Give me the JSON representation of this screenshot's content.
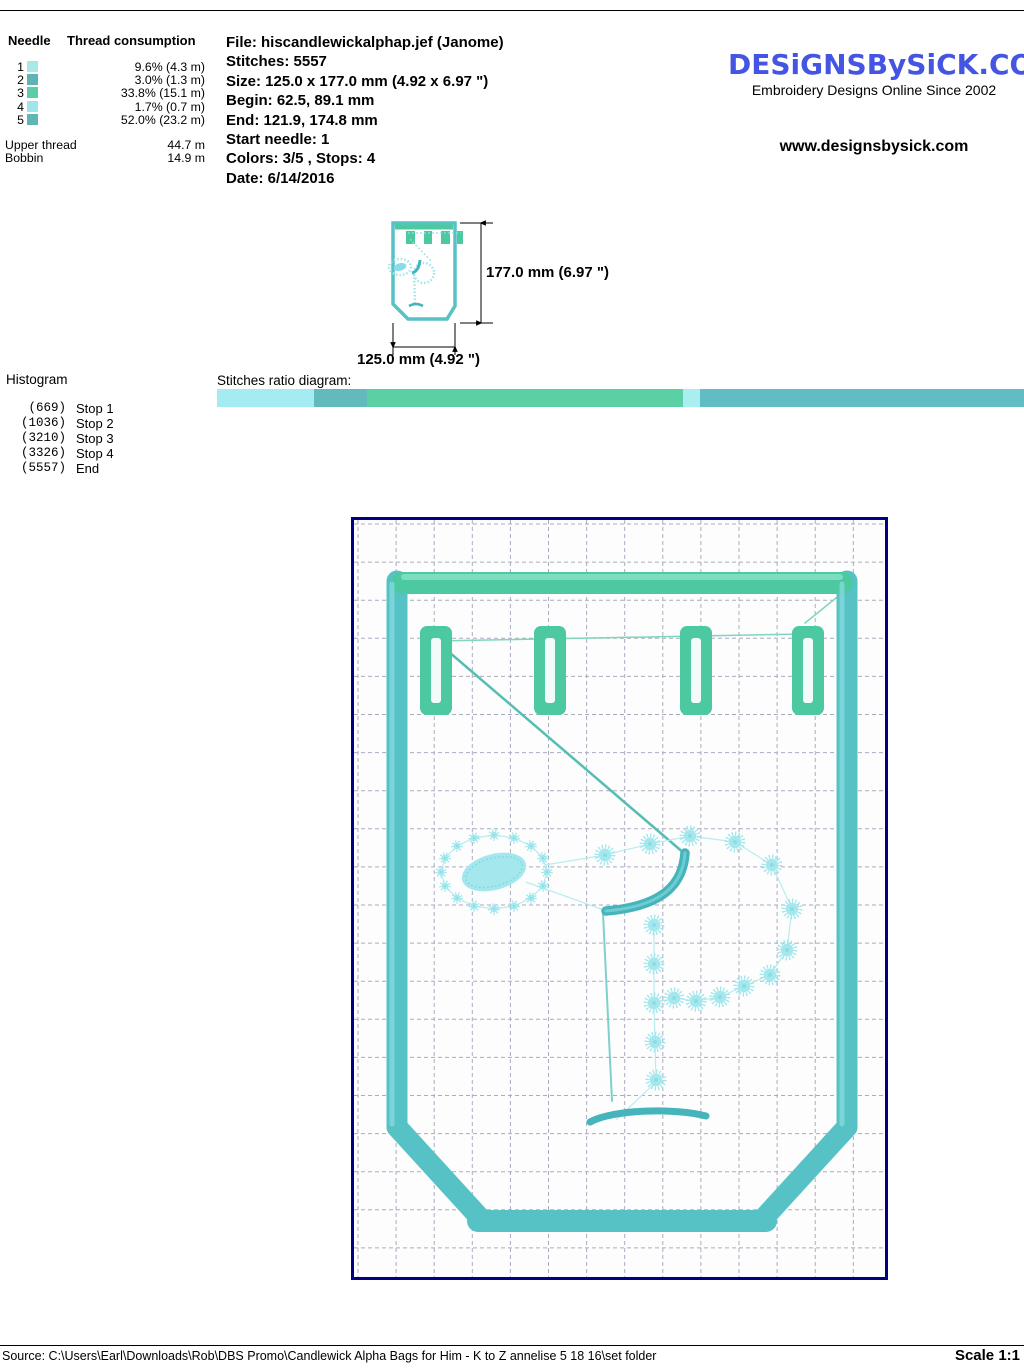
{
  "needle_table": {
    "col_needle": "Needle",
    "col_thread": "Thread consumption",
    "rows": [
      {
        "needle": "1",
        "color": "#a7e9e6",
        "value": "9.6% (4.3 m)"
      },
      {
        "needle": "2",
        "color": "#5fb3b5",
        "value": "3.0% (1.3 m)"
      },
      {
        "needle": "3",
        "color": "#5ccda6",
        "value": "33.8% (15.1 m)"
      },
      {
        "needle": "4",
        "color": "#a0e5eb",
        "value": "1.7% (0.7 m)"
      },
      {
        "needle": "5",
        "color": "#60b6b3",
        "value": "52.0% (23.2 m)"
      }
    ],
    "upper_thread_label": "Upper thread",
    "upper_thread_value": "44.7 m",
    "bobbin_label": "Bobbin",
    "bobbin_value": "14.9 m"
  },
  "file_info": {
    "lines": [
      "File: hiscandlewickalphap.jef  (Janome)",
      "Stitches: 5557",
      "Size: 125.0 x 177.0 mm (4.92 x 6.97 \")",
      "Begin: 62.5, 89.1 mm",
      "End: 121.9, 174.8 mm",
      "Start needle: 1",
      "Colors: 3/5 , Stops: 4",
      "Date: 6/14/2016"
    ]
  },
  "brand": {
    "logo": "DESiGNSBySiCK.COM",
    "logo_color": "#4355e2",
    "tagline": "Embroidery Designs Online Since 2002",
    "website": "www.designsbysick.com"
  },
  "thumbnail": {
    "height_label": "177.0 mm (6.97 \")",
    "width_label": "125.0 mm (4.92 \")"
  },
  "histogram": {
    "title": "Histogram",
    "rows": [
      {
        "count": "(669)",
        "label": "Stop 1"
      },
      {
        "count": "(1036)",
        "label": "Stop 2"
      },
      {
        "count": "(3210)",
        "label": "Stop 3"
      },
      {
        "count": "(3326)",
        "label": "Stop 4"
      },
      {
        "count": "(5557)",
        "label": "End"
      }
    ]
  },
  "ratio": {
    "label": "Stitches ratio diagram:",
    "segments": [
      {
        "pct": 12.04,
        "color": "#a5ecf2"
      },
      {
        "pct": 6.6,
        "color": "#63babd"
      },
      {
        "pct": 39.12,
        "color": "#5bd0a5"
      },
      {
        "pct": 2.09,
        "color": "#abeef2"
      },
      {
        "pct": 40.15,
        "color": "#60bdc4"
      }
    ]
  },
  "design": {
    "colors": {
      "applique_green": "#4cc9a0",
      "green_hi": "#8ae2c6",
      "border_teal": "#56c2c6",
      "teal_hi": "#8adde0",
      "crook_teal": "#45b4bb",
      "star_cyan": "#a4e8ee",
      "star_core": "#7ed4de",
      "thread_light": "#b9ecee",
      "grid": "#a9abc0",
      "slot_fill": "#f2fbfa"
    },
    "grid": {
      "step": 38.1,
      "offset": 4
    },
    "bars": {
      "top": [
        [
          48,
          63
        ],
        [
          488,
          63
        ]
      ],
      "left": [
        [
          43,
          61
        ],
        [
          43,
          607
        ]
      ],
      "right": [
        [
          493,
          61
        ],
        [
          493,
          607
        ]
      ],
      "chamfer_left": [
        [
          43,
          607
        ],
        [
          127,
          699
        ]
      ],
      "chamfer_right": [
        [
          493,
          607
        ],
        [
          409,
          699
        ]
      ],
      "bottom": [
        [
          124,
          701
        ],
        [
          412,
          701
        ]
      ]
    },
    "tabs": {
      "xs": [
        66,
        180,
        326,
        438
      ],
      "y": 106,
      "w": 32,
      "h": 89
    },
    "jump_lines": [
      {
        "pts": [
          [
            80,
            121
          ],
          [
            450,
            114
          ]
        ],
        "w": 1.5,
        "color": "#7dd7b8"
      },
      {
        "pts": [
          [
            451,
            103
          ],
          [
            492,
            70
          ]
        ],
        "w": 1.5,
        "color": "#7dd7b8"
      },
      {
        "pts": [
          [
            95,
            132
          ],
          [
            331,
            334
          ]
        ],
        "w": 2.5,
        "color": "#56bdb2"
      }
    ],
    "stars": {
      "ring_r": 5.5,
      "ring": [
        [
          193,
          352
        ],
        [
          189,
          338
        ],
        [
          177,
          326
        ],
        [
          160,
          318
        ],
        [
          140,
          315
        ],
        [
          120,
          318
        ],
        [
          103,
          326
        ],
        [
          91,
          338
        ],
        [
          87,
          352
        ],
        [
          91,
          366
        ],
        [
          103,
          378
        ],
        [
          120,
          386
        ],
        [
          140,
          389
        ],
        [
          160,
          386
        ],
        [
          177,
          378
        ],
        [
          189,
          366
        ]
      ],
      "bowl_r": 10,
      "bowl": [
        [
          251,
          335
        ],
        [
          296,
          324
        ],
        [
          336,
          316
        ],
        [
          381,
          322
        ],
        [
          418,
          345
        ],
        [
          438,
          389
        ],
        [
          433,
          430
        ],
        [
          416,
          455
        ],
        [
          390,
          466
        ],
        [
          366,
          477
        ],
        [
          342,
          481
        ],
        [
          320,
          478
        ]
      ],
      "stem_r": 10,
      "stem": [
        [
          300,
          405
        ],
        [
          300,
          444
        ],
        [
          300,
          483
        ],
        [
          301,
          522
        ],
        [
          302,
          560
        ]
      ]
    },
    "thin_links": [
      [
        [
          191,
          345
        ],
        [
          251,
          335
        ]
      ],
      [
        [
          172,
          362
        ],
        [
          250,
          390
        ]
      ],
      [
        [
          320,
          478
        ],
        [
          300,
          483
        ]
      ],
      [
        [
          302,
          562
        ],
        [
          262,
          600
        ]
      ]
    ],
    "leaf": {
      "cx": 140,
      "cy": 352,
      "rx": 33,
      "ry": 18,
      "rot": -15
    },
    "crook_path": "M331,333 C329,362 312,386 252,391",
    "serif_path": "M236,602 C260,589 322,588 352,596",
    "stem_guide": [
      [
        249,
        393
      ],
      [
        258,
        581
      ]
    ]
  }
}
